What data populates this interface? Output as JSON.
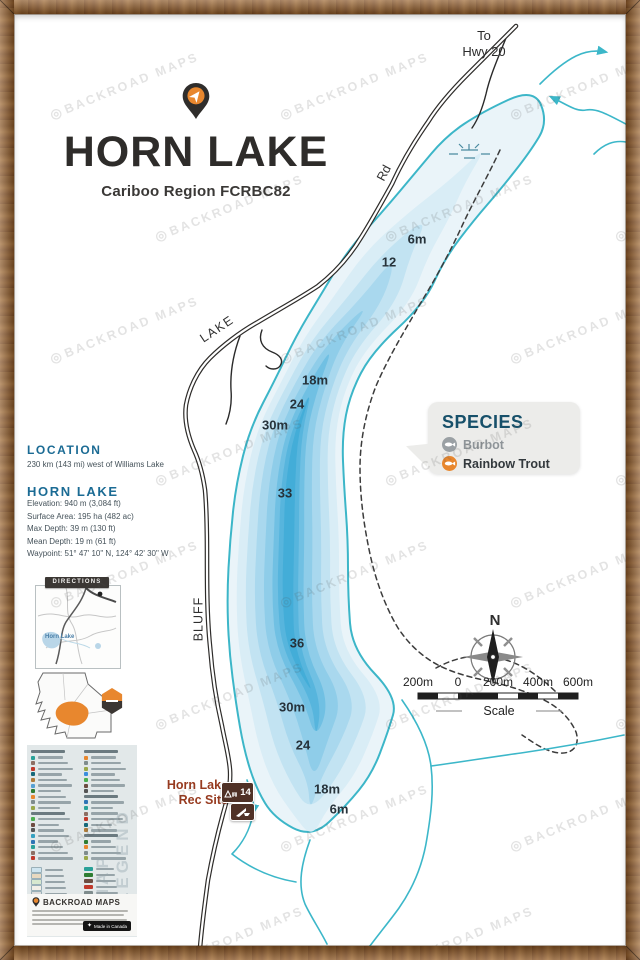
{
  "watermark": {
    "text": "BACKROAD MAPS"
  },
  "header": {
    "title": "HORN LAKE",
    "subtitle": "Cariboo Region FCRBC82"
  },
  "info": {
    "location_heading": "LOCATION",
    "location_text": "230 km (143 mi) west of Williams Lake",
    "lake_heading": "HORN LAKE",
    "stats": [
      "Elevation: 940 m (3,084 ft)",
      "Surface Area: 195 ha (482 ac)",
      "Max Depth: 39 m (130 ft)",
      "Mean Depth: 19 m (61 ft)",
      "Waypoint: 51° 47' 10\" N, 124° 42' 30\" W"
    ]
  },
  "species": {
    "heading": "SPECIES",
    "items": [
      {
        "name": "Burbot",
        "color": "#9aa0a4"
      },
      {
        "name": "Rainbow Trout",
        "color": "#e8872e"
      }
    ]
  },
  "roads": {
    "to_line1": "To",
    "to_line2": "Hwy 20",
    "rd": "Rd",
    "lake": "LAKE",
    "bluff": "BLUFF"
  },
  "rec_site": {
    "line1": "Horn Lake",
    "line2": "Rec Site",
    "badge": "14"
  },
  "depth_labels": [
    {
      "t": "6m",
      "x": 417,
      "y": 239
    },
    {
      "t": "12",
      "x": 389,
      "y": 262
    },
    {
      "t": "18m",
      "x": 315,
      "y": 380
    },
    {
      "t": "24",
      "x": 297,
      "y": 404
    },
    {
      "t": "30m",
      "x": 275,
      "y": 425
    },
    {
      "t": "33",
      "x": 285,
      "y": 493
    },
    {
      "t": "36",
      "x": 297,
      "y": 643
    },
    {
      "t": "30m",
      "x": 292,
      "y": 707
    },
    {
      "t": "24",
      "x": 303,
      "y": 745
    },
    {
      "t": "18m",
      "x": 327,
      "y": 789
    },
    {
      "t": "6m",
      "x": 339,
      "y": 809
    }
  ],
  "compass": {
    "north": "N"
  },
  "scale_bar": {
    "labels": [
      "200m",
      "0",
      "200m",
      "400m",
      "600m"
    ],
    "caption": "Scale"
  },
  "sidebar": {
    "directions": "DIRECTIONS",
    "inset_label": "Horn Lake",
    "legend_title": "MAP LEGEND",
    "brand": "BACKROAD MAPS",
    "made_in": "Made in Canada"
  },
  "palette": {
    "shoreline": "#3cb6c8",
    "stream": "#3cb7c9",
    "road": "#2e2c2a",
    "heading_blue": "#1b6b94",
    "accent_orange": "#e8872e",
    "rec_brown": "#973b20",
    "depth_bands": [
      {
        "label": "shore",
        "color": "#eaf4f9"
      },
      {
        "label": "6m",
        "color": "#d9edf6"
      },
      {
        "label": "12m",
        "color": "#c2e3f2"
      },
      {
        "label": "18m",
        "color": "#a9d8ee"
      },
      {
        "label": "24m",
        "color": "#8fcde9"
      },
      {
        "label": "30m",
        "color": "#70c0e3"
      },
      {
        "label": "33m",
        "color": "#57b5dd"
      },
      {
        "label": "36m",
        "color": "#43add8"
      }
    ]
  }
}
